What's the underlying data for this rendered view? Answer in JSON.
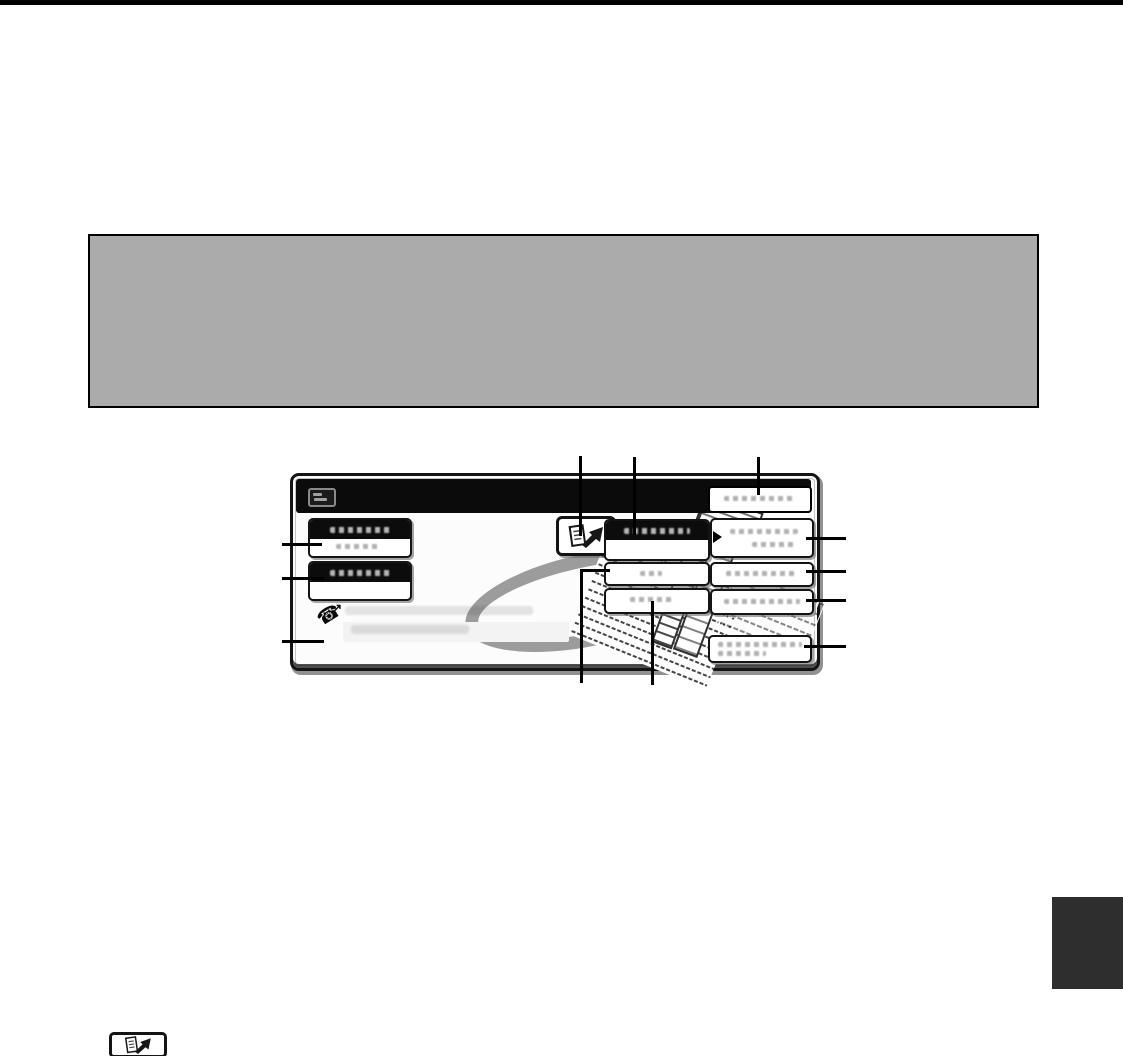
{
  "page": {
    "width": 1123,
    "height": 1056,
    "background": "#ffffff",
    "top_rule_color": "#000000"
  },
  "note_box": {
    "text": "",
    "fill": "#ababab",
    "border_color": "#000000"
  },
  "touch_panel": {
    "frame_color": "#141414",
    "screen_fill": "#fcfcfc",
    "title_bar": {
      "fill": "#0b0b0b",
      "status_icon": "memory-status-icon",
      "button_label": ""
    },
    "left_buttons": [
      {
        "style": "black-top-two-tone",
        "label": "",
        "sub_label": ""
      },
      {
        "style": "black-top-two-tone",
        "label": "",
        "sub_label": ""
      }
    ],
    "icon_button": {
      "icon": "document-arrow-icon"
    },
    "middle_buttons": [
      {
        "style": "black-top-two-tone",
        "label": "",
        "sub_label": ""
      },
      {
        "style": "white",
        "label": ""
      },
      {
        "style": "white",
        "label": ""
      }
    ],
    "right_buttons": [
      {
        "style": "white",
        "marker": "right-triangle-marker",
        "label": ""
      },
      {
        "style": "white",
        "label": ""
      },
      {
        "style": "white",
        "label": ""
      },
      {
        "style": "white",
        "label": ""
      }
    ],
    "phone_hint": {
      "icon": "phone-dial-icon",
      "phone_glyph": "☎",
      "arrow_glyph": "↗",
      "text_line1": "",
      "text_line2": ""
    },
    "artwork": {
      "description": "tilted-document-pages-with-gray-swoosh",
      "swoosh_color": "#9c9c9c"
    }
  },
  "callout_lines": {
    "color": "#000000",
    "top_count": 3,
    "left_count": 3,
    "right_count": 4,
    "bottom_count": 2
  },
  "page_tab": {
    "fill": "#2e2e2e"
  },
  "footer_icon": {
    "icon": "document-arrow-icon"
  }
}
